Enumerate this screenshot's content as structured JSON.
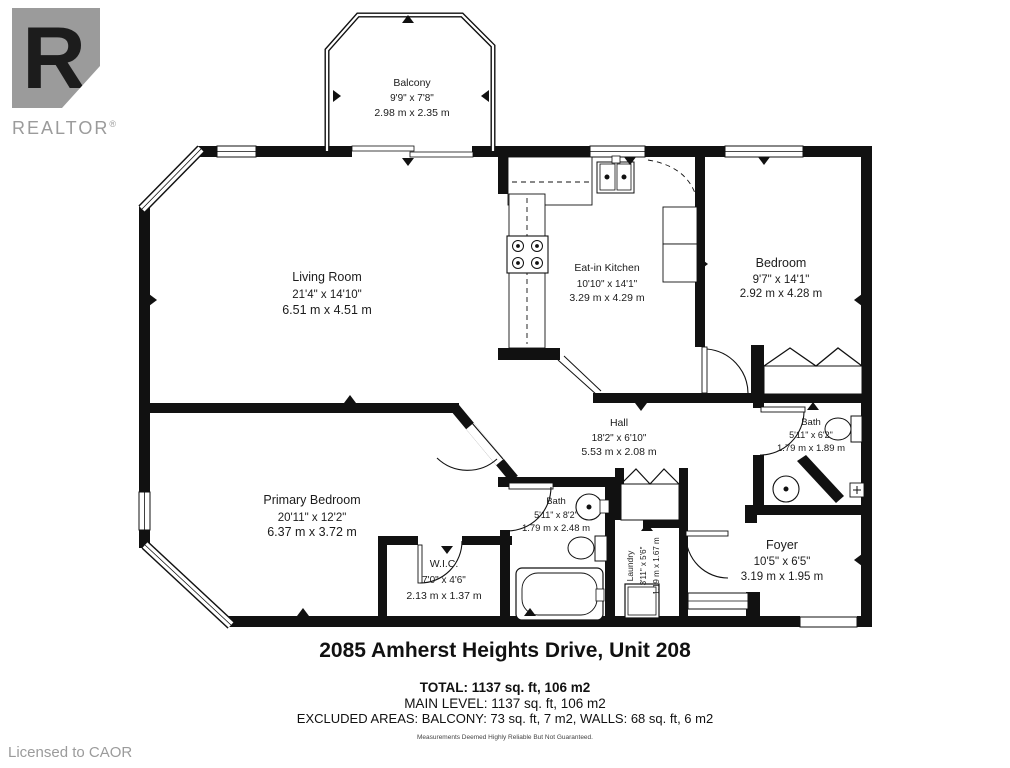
{
  "logo": {
    "letter": "R",
    "brand": "REALTOR",
    "registered": "®"
  },
  "license_text": "Licensed to CAOR",
  "title": "2085 Amherst Heights Drive, Unit 208",
  "summary": {
    "total": "TOTAL: 1137 sq. ft, 106 m2",
    "main_level": "MAIN LEVEL: 1137 sq. ft, 106 m2",
    "excluded": "EXCLUDED AREAS: BALCONY: 73 sq. ft, 7 m2, WALLS: 68 sq. ft, 6 m2",
    "disclaimer": "Measurements Deemed Highly Reliable But Not Guaranteed."
  },
  "rooms": {
    "balcony": {
      "name": "Balcony",
      "imperial": "9'9\" x 7'8\"",
      "metric": "2.98 m x 2.35 m"
    },
    "living_room": {
      "name": "Living Room",
      "imperial": "21'4\" x 14'10\"",
      "metric": "6.51 m x 4.51 m"
    },
    "kitchen": {
      "name": "Eat-in Kitchen",
      "imperial": "10'10\" x 14'1\"",
      "metric": "3.29 m x 4.29 m"
    },
    "bedroom": {
      "name": "Bedroom",
      "imperial": "9'7\" x 14'1\"",
      "metric": "2.92 m x 4.28 m"
    },
    "hall": {
      "name": "Hall",
      "imperial": "18'2\" x 6'10\"",
      "metric": "5.53 m x 2.08 m"
    },
    "bath_main": {
      "name": "Bath",
      "imperial": "5'11\" x 8'2\"",
      "metric": "1.79 m x 2.48 m"
    },
    "bath_small": {
      "name": "Bath",
      "imperial": "5'11\" x 6'2\"",
      "metric": "1.79 m x 1.89 m"
    },
    "primary_bedroom": {
      "name": "Primary Bedroom",
      "imperial": "20'11\" x 12'2\"",
      "metric": "6.37 m x 3.72 m"
    },
    "wic": {
      "name": "W.I.C.",
      "imperial": "7'0\" x 4'6\"",
      "metric": "2.13 m x 1.37 m"
    },
    "laundry": {
      "name": "Laundry",
      "imperial": "3'11\" x 5'6\"",
      "metric": "1.19 m x 1.67 m"
    },
    "foyer": {
      "name": "Foyer",
      "imperial": "10'5\" x 6'5\"",
      "metric": "3.19 m x 1.95 m"
    }
  },
  "colors": {
    "wall": "#111111",
    "label": "#1c1c1c",
    "logo_gray": "#9b9b9b"
  }
}
